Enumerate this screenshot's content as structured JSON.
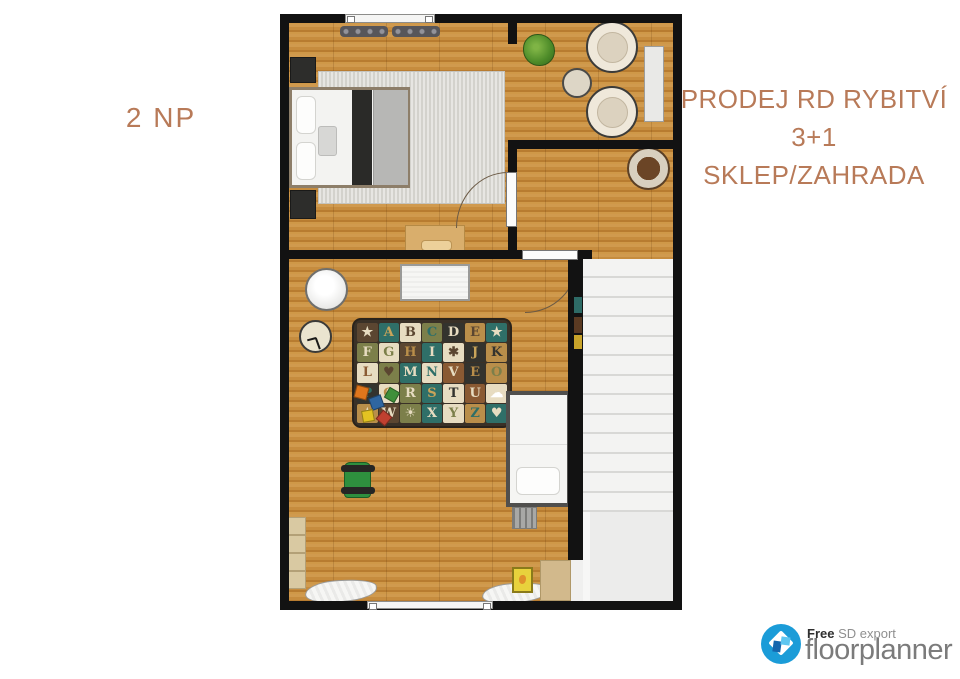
{
  "labels": {
    "floor": "2 NP",
    "title1": "PRODEJ RD RYBITVÍ",
    "title2": "3+1",
    "title3": "SKLEP/ZAHRADA",
    "accent_color": "#b87a58"
  },
  "branding": {
    "free": "Free",
    "export_type": "SD export",
    "brand": "floorplanner",
    "logo_blue": "#1b9cd8",
    "brand_gray": "#7b7b7b"
  },
  "plan": {
    "colors": {
      "wall": "#121212",
      "wood_floor": "#c28a3c",
      "bedroom_rug": "#dad9d3",
      "stairs": "#f3f3f2"
    },
    "stairs": {
      "steps": 13
    },
    "rooms": [
      "bedroom",
      "lounge-corner",
      "hall",
      "children-room",
      "staircase"
    ],
    "furniture_icons": [
      "double-bed",
      "nightstand",
      "desk",
      "radiator",
      "window",
      "door",
      "armchair",
      "side-table",
      "plant",
      "sideboard",
      "rattan-chair",
      "changing-mat",
      "pouf",
      "wall-clock",
      "alphabet-rug",
      "toy-blocks",
      "kart-toy",
      "bookshelf",
      "clothes-pile",
      "single-bed",
      "ladder",
      "toy-box"
    ],
    "alphabet_rug": {
      "rows": 5,
      "cols": 7,
      "tiles": [
        {
          "ch": "★",
          "bg": "#5b4631",
          "fg": "#e7dcc1"
        },
        {
          "ch": "A",
          "bg": "#2f6f68",
          "fg": "#c9a45a"
        },
        {
          "ch": "B",
          "bg": "#e7dcc1",
          "fg": "#5b4631"
        },
        {
          "ch": "C",
          "bg": "#7c7f4a",
          "fg": "#2f6f68"
        },
        {
          "ch": "D",
          "bg": "#33332e",
          "fg": "#e7dcc1"
        },
        {
          "ch": "E",
          "bg": "#b98e4a",
          "fg": "#5b4631"
        },
        {
          "ch": "★",
          "bg": "#2f6f68",
          "fg": "#e7dcc1"
        },
        {
          "ch": "F",
          "bg": "#7c7f4a",
          "fg": "#e7dcc1"
        },
        {
          "ch": "G",
          "bg": "#e7dcc1",
          "fg": "#7c7f4a"
        },
        {
          "ch": "H",
          "bg": "#5b4631",
          "fg": "#b98e4a"
        },
        {
          "ch": "I",
          "bg": "#2f6f68",
          "fg": "#e7dcc1"
        },
        {
          "ch": "✱",
          "bg": "#e7dcc1",
          "fg": "#5b4631"
        },
        {
          "ch": "J",
          "bg": "#33332e",
          "fg": "#c9a45a"
        },
        {
          "ch": "K",
          "bg": "#b98e4a",
          "fg": "#33332e"
        },
        {
          "ch": "L",
          "bg": "#e7dcc1",
          "fg": "#8a5a33"
        },
        {
          "ch": "♥",
          "bg": "#7c7f4a",
          "fg": "#5b4631"
        },
        {
          "ch": "M",
          "bg": "#2f6f68",
          "fg": "#e7dcc1"
        },
        {
          "ch": "N",
          "bg": "#e7dcc1",
          "fg": "#2f6f68"
        },
        {
          "ch": "V",
          "bg": "#8a5a33",
          "fg": "#e7dcc1"
        },
        {
          "ch": "E",
          "bg": "#33332e",
          "fg": "#b98e4a"
        },
        {
          "ch": "O",
          "bg": "#b98e4a",
          "fg": "#7c7f4a"
        },
        {
          "ch": "P",
          "bg": "#33332e",
          "fg": "#2f6f68"
        },
        {
          "ch": "Q",
          "bg": "#e7dcc1",
          "fg": "#b98e4a"
        },
        {
          "ch": "R",
          "bg": "#7c7f4a",
          "fg": "#e7dcc1"
        },
        {
          "ch": "S",
          "bg": "#2f6f68",
          "fg": "#c9a45a"
        },
        {
          "ch": "T",
          "bg": "#e7dcc1",
          "fg": "#33332e"
        },
        {
          "ch": "U",
          "bg": "#8a5a33",
          "fg": "#e7dcc1"
        },
        {
          "ch": "☁",
          "bg": "#e7dcc1",
          "fg": "#ffffff"
        },
        {
          "ch": "★",
          "bg": "#b98e4a",
          "fg": "#e7dcc1"
        },
        {
          "ch": "W",
          "bg": "#5b4631",
          "fg": "#e7dcc1"
        },
        {
          "ch": "☀",
          "bg": "#7c7f4a",
          "fg": "#e7dcc1"
        },
        {
          "ch": "X",
          "bg": "#2f6f68",
          "fg": "#e7dcc1"
        },
        {
          "ch": "Y",
          "bg": "#e7dcc1",
          "fg": "#7c7f4a"
        },
        {
          "ch": "Z",
          "bg": "#b98e4a",
          "fg": "#2f6f68"
        },
        {
          "ch": "♥",
          "bg": "#2f6f68",
          "fg": "#e7dcc1"
        }
      ]
    }
  }
}
